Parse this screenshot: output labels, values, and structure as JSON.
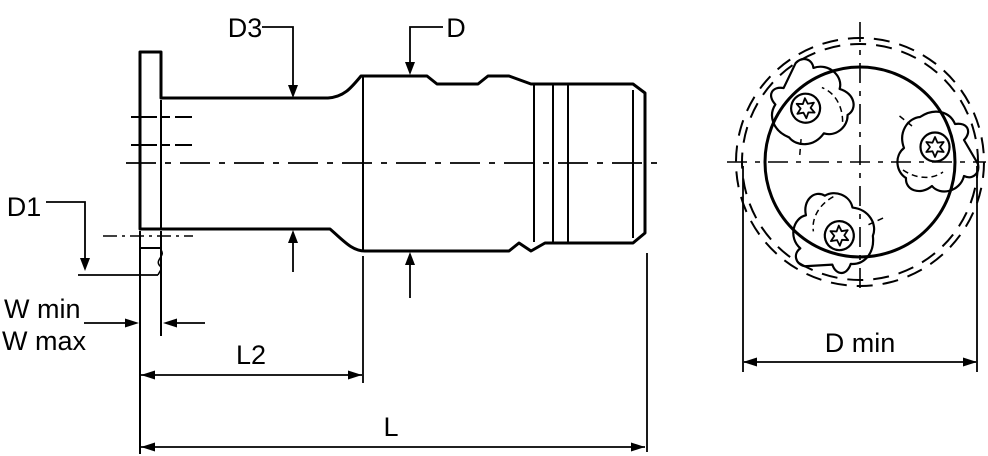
{
  "diagram": {
    "type": "technical-drawing",
    "colors": {
      "body_fill": "#d8d8d8",
      "line": "#000000",
      "background": "#ffffff"
    },
    "side_view": {
      "labels": {
        "d3": "D3",
        "d": "D",
        "d1": "D1",
        "w_min": "W min",
        "w_max": "W max",
        "l2": "L2",
        "l": "L"
      }
    },
    "front_view": {
      "labels": {
        "d_min": "D min"
      },
      "insert_count": 3
    }
  }
}
